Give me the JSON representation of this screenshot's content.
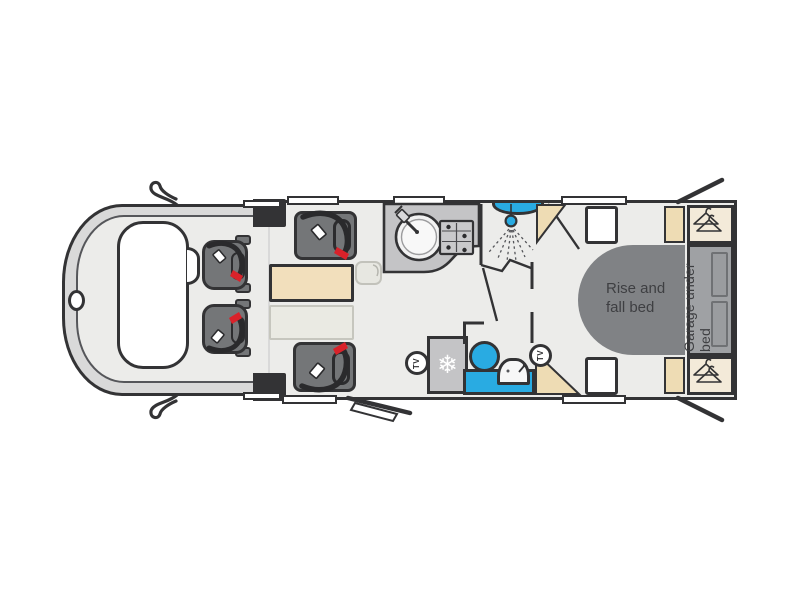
{
  "labels": {
    "bed_line1": "Rise and",
    "bed_line2": "fall bed",
    "garage": "Garage under bed",
    "tv_front": "TV",
    "tv_rear": "TV"
  },
  "icons": {
    "freezer_glyph": "❄",
    "wardrobe_icon": "coat-hanger",
    "shower_icon": "shower-head-with-spray",
    "seat_icon": "belted-travel-seat"
  },
  "colors": {
    "outline": "#333335",
    "floor": "#ececea",
    "fixture_blue": "#29abe2",
    "seatbelt_red": "#d9222a",
    "table_beige": "#f2dfbc",
    "shelf_beige": "#eedcb4",
    "wardrobe_cream": "#f3ead9",
    "counter_gray": "#c4c4c6",
    "seat_gray": "#747678",
    "bed_gray": "#808285",
    "garage_gray": "#9fa1a4",
    "cab_gray": "#d9d9d9"
  }
}
